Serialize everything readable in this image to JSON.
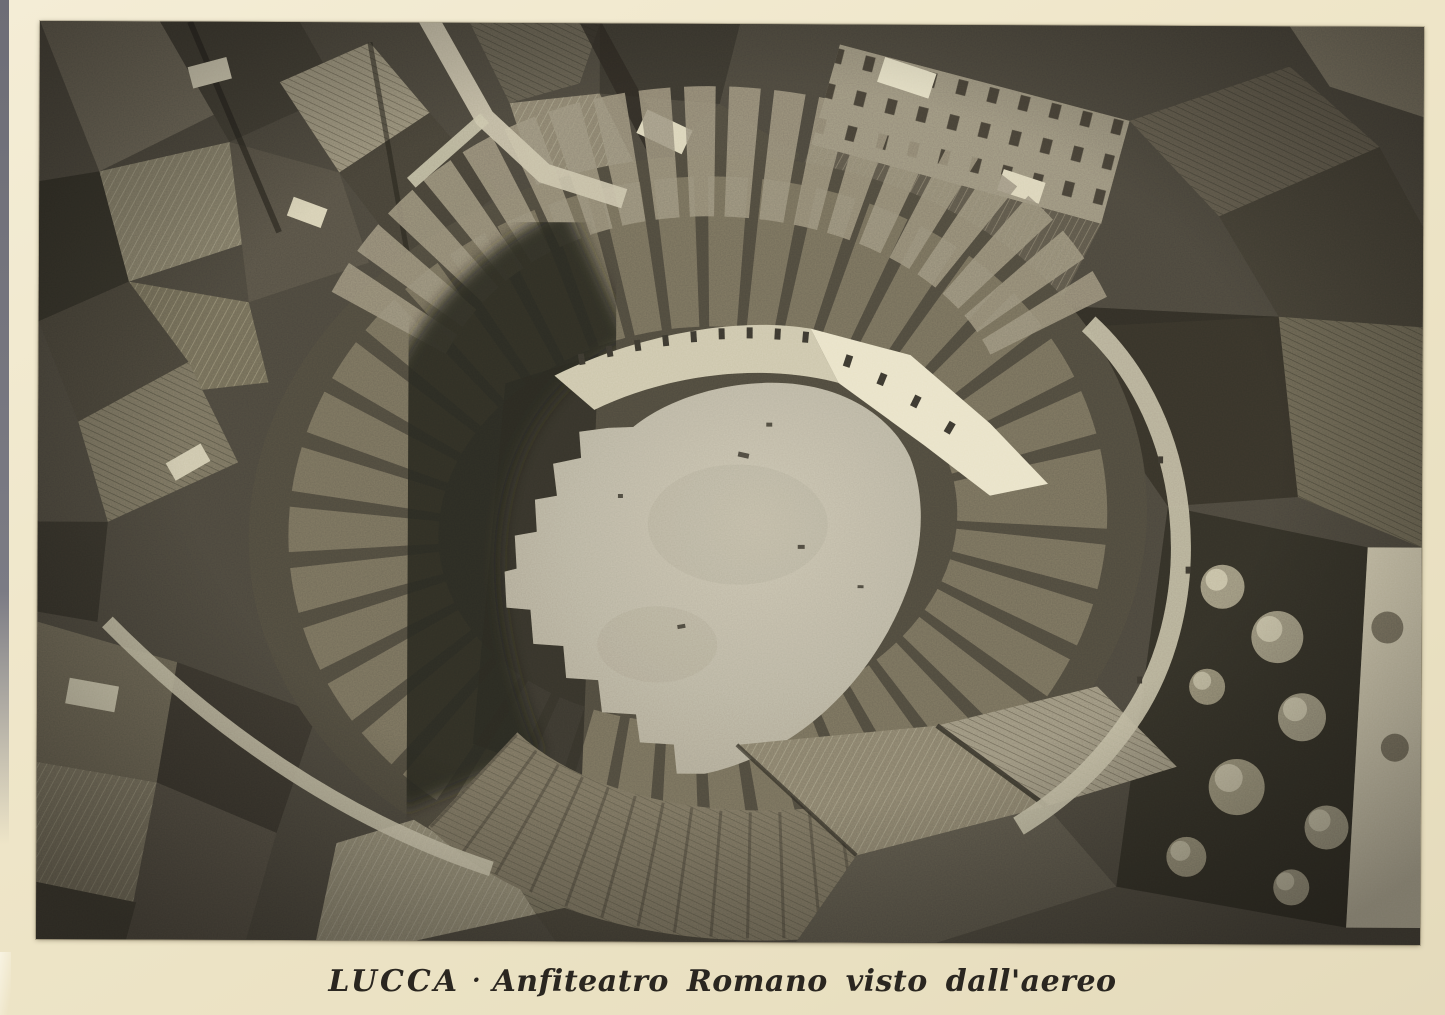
{
  "caption": {
    "place": "LUCCA",
    "separator": "·",
    "title": "Anfiteatro Romano visto dall'aereo"
  },
  "photo": {
    "description": "Black-and-white aerial photograph of Lucca's Roman Amphitheatre: an elliptical ring of tiled-roof buildings encloses the bright oval piazza, surrounded by the dense rooftops and narrow streets of the old town, with a tree-filled garden at the lower right.",
    "medium": "vintage photo postcard on cream card stock"
  },
  "colors": {
    "card_background": "#efe6c9",
    "caption_text": "#2a2620",
    "scan_edge_gray": "#75757e",
    "photo_base_dark": "#3e3a33",
    "shadow_dark": "#211e19",
    "roof_mid_gray": "#6e675a",
    "plaza_light": "#b3ad9d",
    "facade_highlight": "#e9e2c8"
  }
}
